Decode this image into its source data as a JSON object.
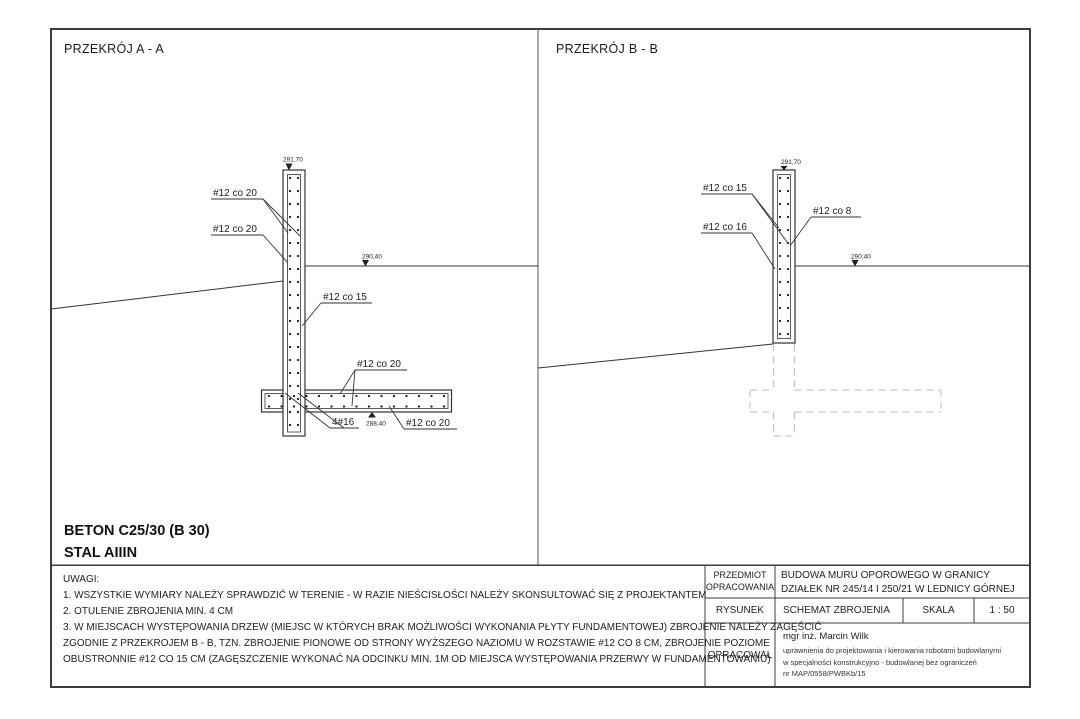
{
  "panel_a": {
    "title": "PRZEKRÓJ A - A",
    "elev_top": "291,70",
    "elev_ground": "290,40",
    "elev_footing": "288,40",
    "label_wall_bars_1": "#12 co 20",
    "label_wall_bars_2": "#12 co 20",
    "label_wall_vertical": "#12 co 15",
    "label_footing_top": "#12 co 20",
    "label_footing_bottom": "#12 co 20",
    "label_corner_bars": "4#16"
  },
  "panel_b": {
    "title": "PRZEKRÓJ B - B",
    "elev_top": "291,70",
    "elev_ground": "290,40",
    "label_wall_horizontal": "#12 co 15",
    "label_wall_dense": "#12 co 8",
    "label_wall_back": "#12 co 16"
  },
  "materials": {
    "concrete": "BETON C25/30 (B 30)",
    "steel": "STAL AIIIN"
  },
  "notes": {
    "heading": "UWAGI:",
    "lines": [
      "1. WSZYSTKIE WYMIARY NALEŻY SPRAWDZIĆ W TERENIE - W RAZIE NIEŚCISŁOŚCI NALEŻY SKONSULTOWAĆ SIĘ Z PROJEKTANTEM",
      "2. OTULENIE ZBROJENIA MIN. 4 CM",
      "3. W MIEJSCACH WYSTĘPOWANIA DRZEW (MIEJSC W KTÓRYCH BRAK MOŻLIWOŚCI WYKONANIA PŁYTY FUNDAMENTOWEJ) ZBROJENIE NALEŻY ZAGĘŚCIĆ",
      "ZGODNIE Z PRZEKROJEM B - B, TZN. ZBROJENIE PIONOWE OD STRONY WYŻSZEGO NAZIOMU W ROZSTAWIE #12 CO 8 CM, ZBROJENIE POZIOME",
      "OBUSTRONNIE #12 CO 15 CM (ZAGĘSZCZENIE WYKONAĆ NA ODCINKU MIN. 1M OD MIEJSCA WYSTĘPOWANIA PRZERWY W FUNDAMENTOWANIU)"
    ]
  },
  "title_block": {
    "subject_label_line1": "PRZEDMIOT",
    "subject_label_line2": "OPRACOWANIA",
    "subject_line1": "BUDOWA MURU OPOROWEGO W GRANICY",
    "subject_line2": "DZIAŁEK NR 245/14 I 250/21 W LEDNICY GÓRNEJ",
    "drawing_label": "RYSUNEK",
    "drawing_value": "SCHEMAT ZBROJENIA",
    "scale_label": "SKALA",
    "scale_value": "1 : 50",
    "author_label": "OPRACOWAŁ",
    "author_name": "mgr inż. Marcin Wilk",
    "author_line1": "uprawnienia do projektowania i kierowania robotami budowlanymi",
    "author_line2": "w specjalności konstrukcyjno - budowlanej bez ograniczeń",
    "author_line3": "nr MAP/0558/PWBKb/15"
  }
}
